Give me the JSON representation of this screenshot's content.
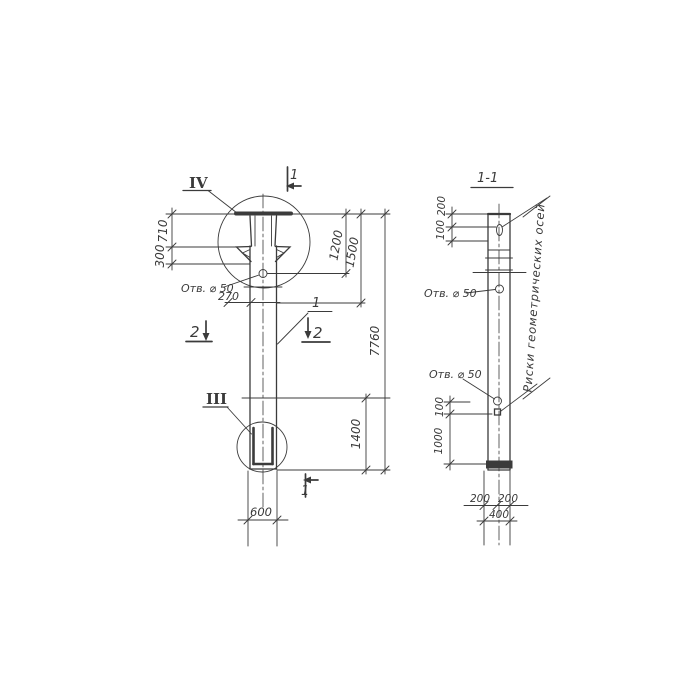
{
  "left_view": {
    "detail_top_label": "IV",
    "detail_bottom_label": "III",
    "cut_top_label": "1",
    "cut_bottom_label": "1",
    "cut_left_label": "2",
    "cut_right_label": "2",
    "position_label": "1",
    "hole_label": "Отв. ⌀ 50",
    "dim_710": "710",
    "dim_300": "300",
    "dim_270": "270",
    "dim_1200": "1200",
    "dim_1500": "1500",
    "dim_7760": "7760",
    "dim_1400": "1400",
    "dim_600": "600"
  },
  "section_view": {
    "title": "1-1",
    "hole_label_upper": "Отв. ⌀ 50",
    "hole_label_lower": "Отв. ⌀ 50",
    "axes_note": "Риски геометрических осей",
    "dim_200_top": "200",
    "dim_100_top": "100",
    "dim_100_lower": "100",
    "dim_1000": "1000",
    "dim_200_bottom_left": "200",
    "dim_200_bottom_right": "200",
    "dim_400": "400"
  }
}
